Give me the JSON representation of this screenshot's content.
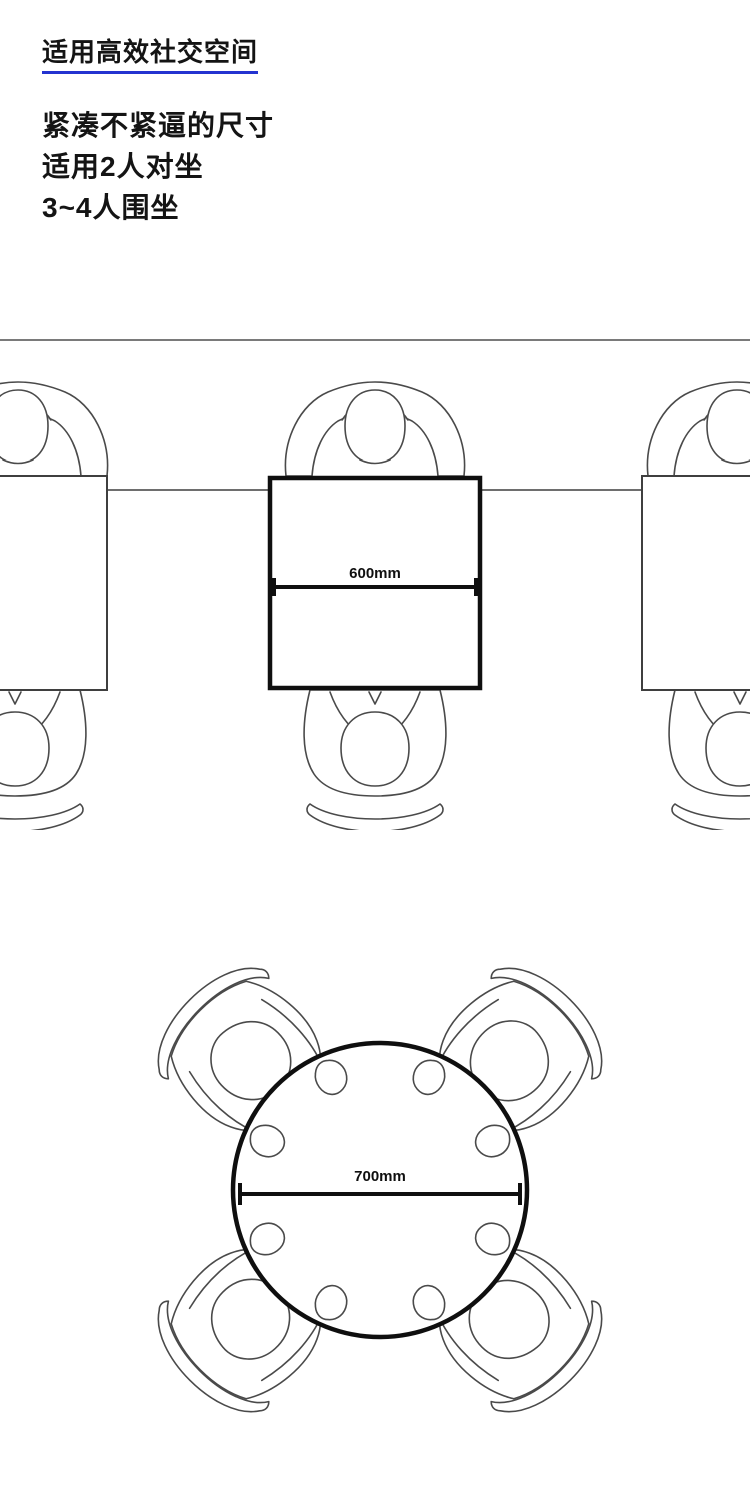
{
  "header": {
    "title": "适用高效社交空间",
    "lines": {
      "l1": "紧凑不紧逼的尺寸",
      "l2": "适用2人对坐",
      "l3": "3~4人围坐"
    }
  },
  "square_diagram": {
    "table_shape": "square",
    "dimension_label": "600mm",
    "seated_people": 2
  },
  "round_diagram": {
    "table_shape": "round",
    "dimension_label": "700mm",
    "seated_people": 4
  },
  "colors": {
    "underline_accent": "#2433d0",
    "divider": "#7a7a7a",
    "table_outline": "#0f0f0f",
    "figure_outline": "#4a4a4a"
  }
}
